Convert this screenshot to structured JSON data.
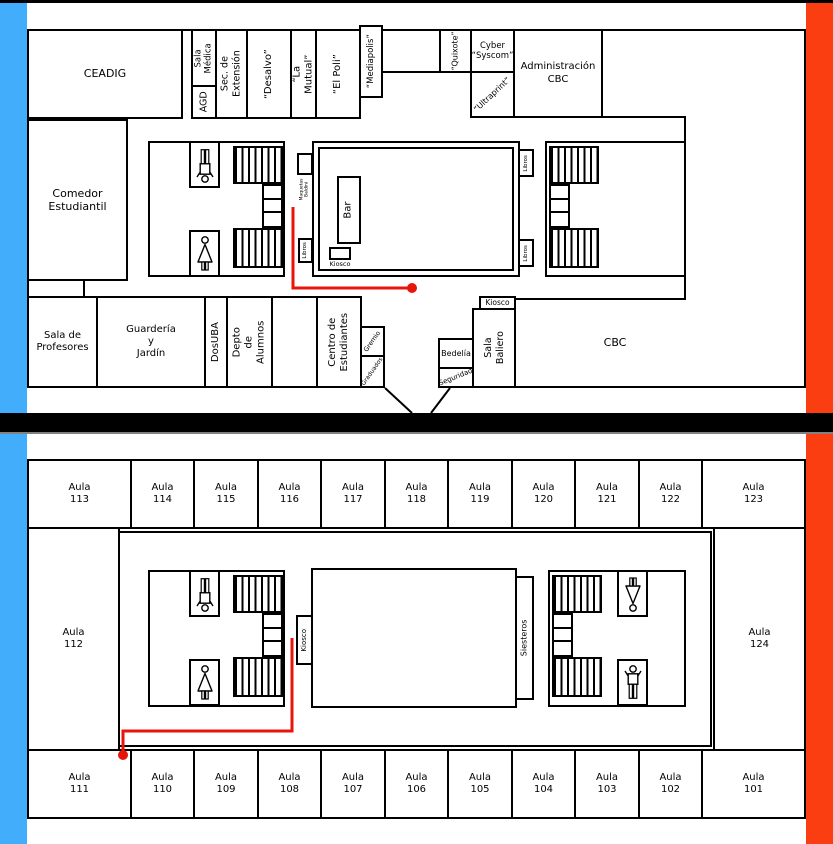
{
  "colors": {
    "stripe_blue": "#41ADFB",
    "stripe_orange": "#FA3E11",
    "route_red": "#E8150C",
    "wall_black": "#000000",
    "divider_gray": "#808080"
  },
  "upper_floor": {
    "ceadig": "CEADIG",
    "sala_medica": "Sala\nMédica",
    "agd": "AGD",
    "sec_extension": "Sec. de\nExtensión",
    "desalvo": "“Desalvo”",
    "la_mutual": "“La Mutual”",
    "el_poli": "“El Poli”",
    "mediapolis": "“Mediapolis”",
    "quixote": "“Quixote”",
    "cyber_syscom": "Cyber\n“Syscom”",
    "ultraprint": "“Ultraprint”",
    "administracion": "Administración\nCBC",
    "comedor": "Comedor\nEstudiantil",
    "sala_profesores": "Sala de\nProfesores",
    "guarderia": "Guardería\ny\nJardín",
    "dosuba": "DosUBA",
    "depto_alumnos": "Depto de\nAlumnos",
    "centro_estudiantes": "Centro de\nEstudiantes",
    "gremio": "Gremio",
    "graduados": "Graduados",
    "bedelia": "Bedelía",
    "seguridad": "Seguridad",
    "kiosco_baliero": "Kiosco",
    "sala_baliero": "Sala\nBaliero",
    "cbc": "CBC",
    "bar": "Bar",
    "kiosco_patio": "Kiosco",
    "maquetas": "Maquetas\nBaldini",
    "libros_left": "Libros",
    "libros_right_top": "Libros",
    "libros_right_bottom": "Libros"
  },
  "lower_floor": {
    "top_row": [
      "Aula\n113",
      "Aula\n114",
      "Aula\n115",
      "Aula\n116",
      "Aula\n117",
      "Aula\n118",
      "Aula\n119",
      "Aula\n120",
      "Aula\n121",
      "Aula\n122",
      "Aula\n123"
    ],
    "bottom_row": [
      "Aula\n111",
      "Aula\n110",
      "Aula\n109",
      "Aula\n108",
      "Aula\n107",
      "Aula\n106",
      "Aula\n105",
      "Aula\n104",
      "Aula\n103",
      "Aula\n102",
      "Aula\n101"
    ],
    "aula_left": "Aula\n112",
    "aula_right": "Aula\n124",
    "kiosco": "Kiosco",
    "siesteros": "Siesteros"
  },
  "icons": {
    "male_restroom": "male-restroom-icon",
    "female_restroom": "female-restroom-icon",
    "stairs": "stairs-hatch"
  }
}
